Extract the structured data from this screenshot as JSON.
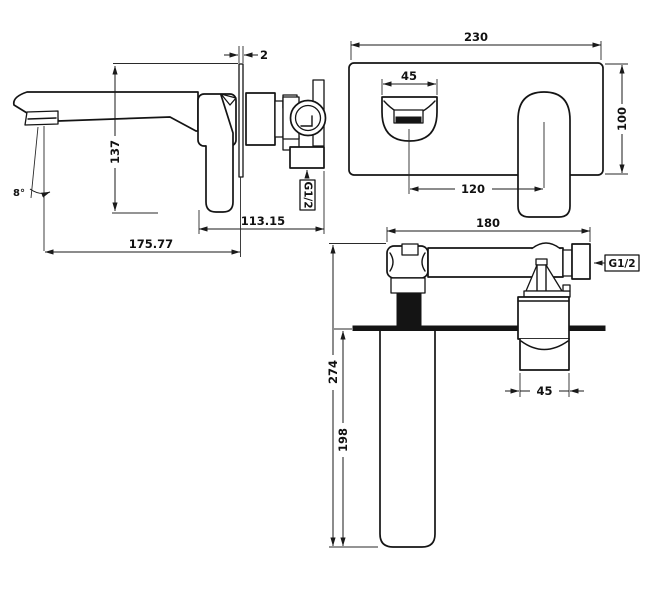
{
  "drawing": {
    "title": "Wall-mounted basin mixer installation drawing",
    "side_view": {
      "dim_plate_thickness": "2",
      "dim_height": "137",
      "dim_angle": "8°",
      "dim_body_depth": "113.15",
      "dim_spout_reach": "175.77",
      "thread_label": "G1/2"
    },
    "front_view": {
      "dim_plate_width": "230",
      "dim_spout_width": "45",
      "dim_plate_height": "100",
      "dim_center_spacing": "120"
    },
    "plan_view": {
      "dim_body_width": "180",
      "thread_label": "G1/2",
      "dim_total_depth": "274",
      "dim_projection": "198",
      "dim_handle_width": "45"
    },
    "colors": {
      "line": "#141414",
      "background": "#ffffff"
    }
  }
}
